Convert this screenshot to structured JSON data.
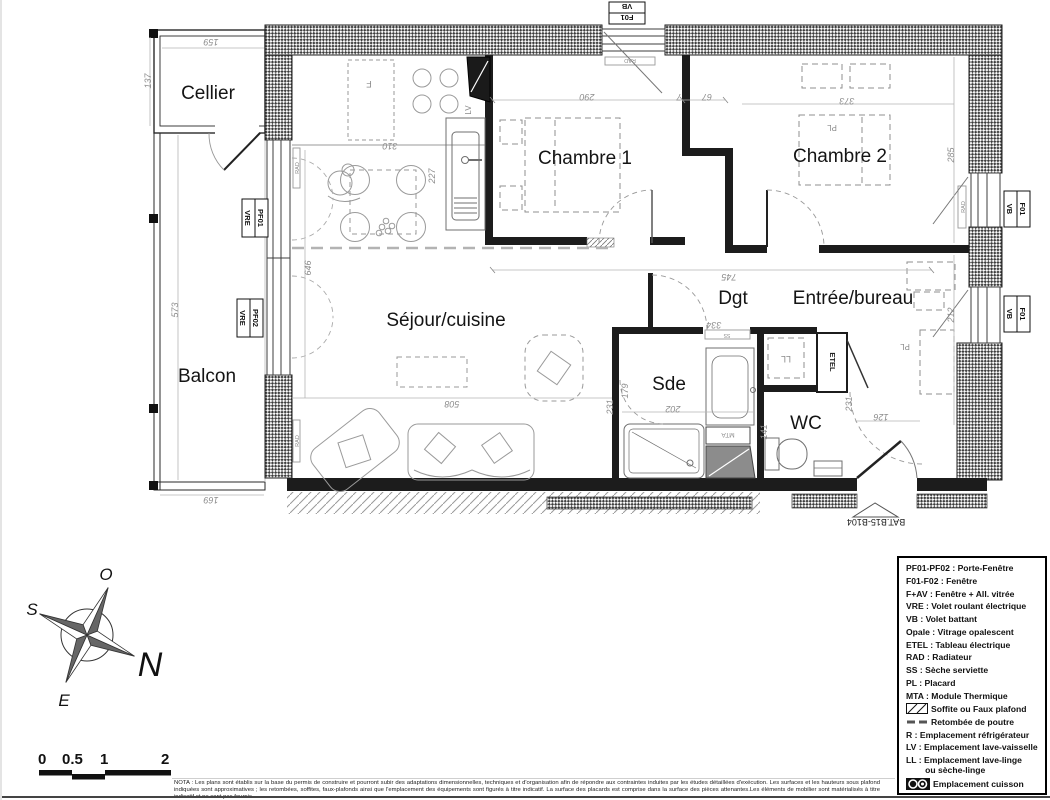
{
  "plan": {
    "rooms": {
      "cellier": "Cellier",
      "chambre1": "Chambre 1",
      "chambre2": "Chambre 2",
      "sejour": "Séjour/cuisine",
      "balcon": "Balcon",
      "dgt": "Dgt",
      "entree": "Entrée/bureau",
      "sde": "Sde",
      "wc": "WC"
    },
    "dims": {
      "d159": "159",
      "d137": "137",
      "d573": "573",
      "d169": "169",
      "d646": "646",
      "d310": "310",
      "d227": "227",
      "d290": "290",
      "d7": "7",
      "d67": "67",
      "d373": "373",
      "d285": "285",
      "d212": "212",
      "d745": "745",
      "d508": "508",
      "d202": "202",
      "d179": "179",
      "d141": "141",
      "d231a": "231",
      "d231b": "231",
      "d126": "126",
      "d334": "334"
    },
    "ann": {
      "rad": "RAD",
      "lv": "LV",
      "f": "F",
      "ll": "LL",
      "etel": "ETEL",
      "ss": "SS",
      "pl": "PL",
      "mta": "MTA",
      "bat": "BAT.B15-B104"
    },
    "tags": {
      "top1": "VB",
      "top2": "F01",
      "pf01a": "PF01",
      "pf01b": "VRE",
      "pf02a": "PF02",
      "pf02b": "VRE",
      "f01": "F01",
      "vb": "VB"
    }
  },
  "compass": {
    "o": "O",
    "s": "S",
    "e": "E",
    "n": "N"
  },
  "scale": {
    "l0": "0",
    "l05": "0.5",
    "l1": "1",
    "l2": "2"
  },
  "legend": {
    "items": [
      "PF01-PF02 : Porte-Fenêtre",
      "F01-F02 : Fenêtre",
      "F+AV : Fenêtre + All. vitrée",
      "VRE : Volet roulant électrique",
      "VB : Volet battant",
      "Opale : Vitrage opalescent",
      "ETEL : Tableau électrique",
      "RAD : Radiateur",
      "SS : Sèche serviette",
      "PL : Placard",
      "MTA : Module Thermique",
      "Soffite ou Faux plafond",
      "Retombée de poutre",
      "R : Emplacement réfrigérateur",
      "LV : Emplacement lave-vaisselle",
      "LL : Emplacement lave-linge\n        ou sèche-linge",
      "Emplacement cuisson"
    ]
  },
  "nota": "NOTA : Les plans sont établis sur la base du permis de construire et pourront subir des adaptations dimensionnelles, techniques et d'organisation afin de répondre aux contraintes induites par les études détaillées d'exécution. Les surfaces et les hauteurs sous plafond indiquées sont approximatives ; les retombées, soffites, faux-plafonds ainsi que l'emplacement des équipements sont figurés à titre indicatif. La surface des placards est comprise dans la surface des pièces attenantes.Les éléments de mobilier sont matérialisés à titre indicatif et ne sont pas fournis."
}
